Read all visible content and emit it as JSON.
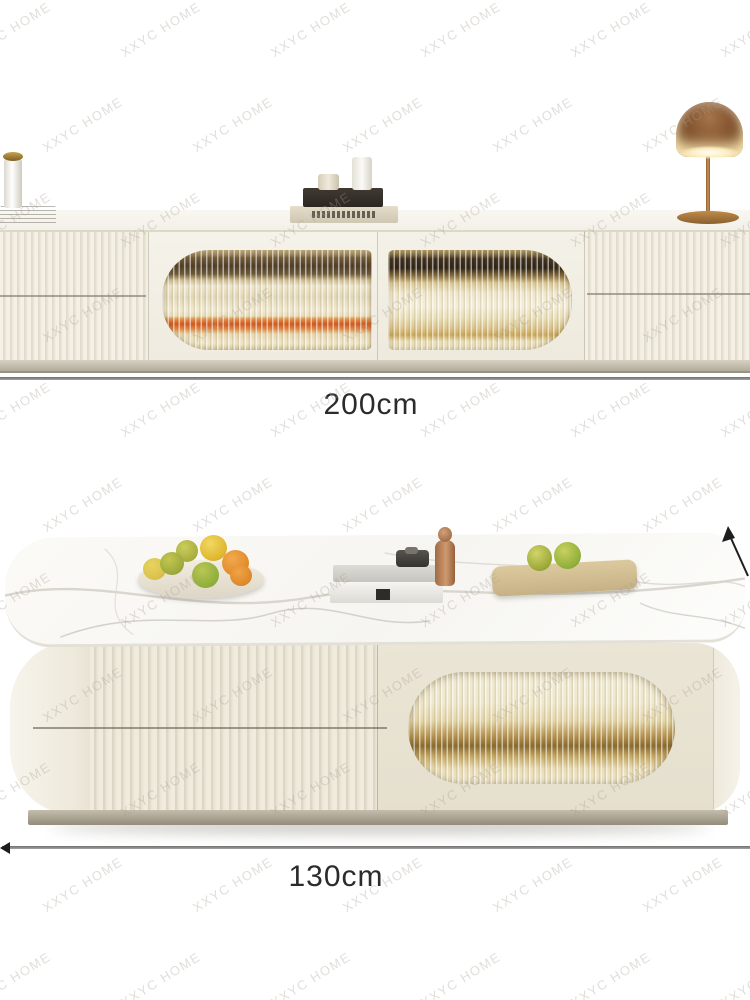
{
  "page": {
    "width": 750,
    "height": 1000,
    "background": "#ffffff",
    "type": "furniture-product-photo"
  },
  "watermark": {
    "text": "XXYC HOME",
    "color": "rgba(166,159,147,0.34)",
    "rotation_deg": -32,
    "grid": {
      "x_start": -35,
      "x_step": 150,
      "y_start": 22,
      "y_step": 95,
      "row_offset": 72,
      "cols": 7,
      "rows": 11
    }
  },
  "tv_stand_scene": {
    "description": "cream fluted TV stand with two reeded-glass doors, styled with vase, magazine, books, candles and bronze table lamp",
    "dimension": {
      "label": "200cm",
      "line_color": "#8f8f8f",
      "text_color": "#2b2b2b"
    },
    "decor_items": [
      "vase",
      "magazine",
      "book-stack",
      "candles",
      "table-lamp"
    ]
  },
  "coffee_table_scene": {
    "description": "cream fluted coffee table with marble top and oval reeded-glass panel, styled with fruit plate, books, figurine and serving board",
    "dimension": {
      "label": "130cm",
      "line_color": "#8f8f8f",
      "text_color": "#2b2b2b"
    },
    "decor_items": [
      "fruit-plate",
      "book-stack",
      "figurine",
      "serving-board"
    ]
  },
  "palette": {
    "cabinet_cream": "#f0ece1",
    "flute_shadow": "#d8d2c1",
    "glass_gold": "#e7d9ad",
    "glass_dark_contents": "#4d3c28",
    "accent_orange": "#d4571e",
    "lamp_bronze": "#7d4e2a",
    "marble_white": "#fbfaf7",
    "plinth_greige": "#b2ac9c",
    "dimension_line": "#8f8f8f",
    "dimension_text": "#2b2b2b"
  }
}
